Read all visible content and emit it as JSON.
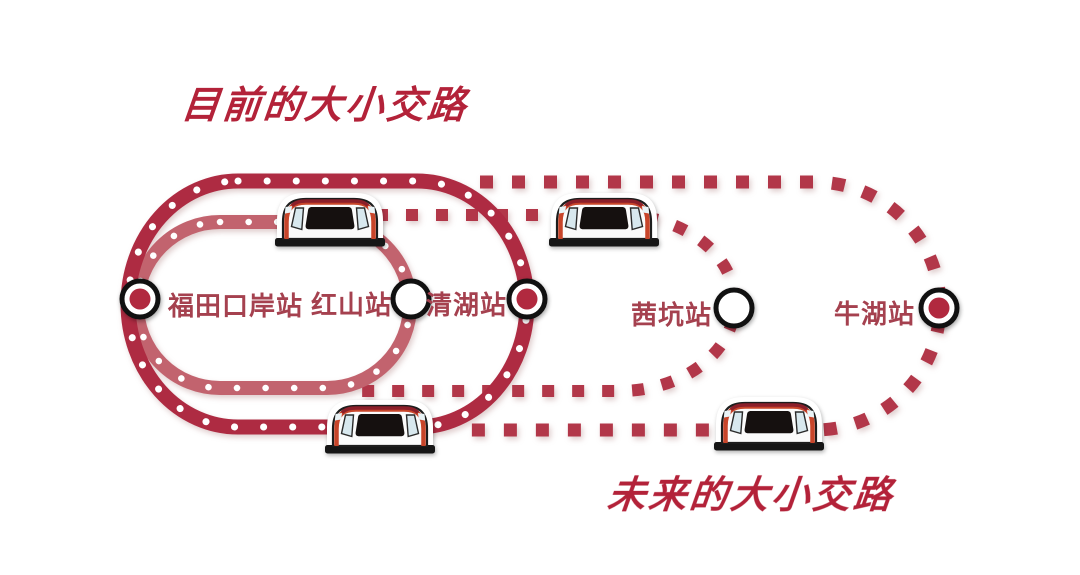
{
  "titles": {
    "current": "目前的大小交路",
    "future": "未来的大小交路"
  },
  "stations": [
    {
      "name": "福田口岸站",
      "marker": "filled"
    },
    {
      "name": "红山站",
      "marker": "hollow"
    },
    {
      "name": "清湖站",
      "marker": "filled"
    },
    {
      "name": "茜坑站",
      "marker": "hollow"
    },
    {
      "name": "牛湖站",
      "marker": "filled"
    }
  ],
  "routes": [
    {
      "name": "current-small-loop",
      "style": "solid-band-white-dots",
      "from": "福田口岸站",
      "to": "红山站"
    },
    {
      "name": "current-large-loop",
      "style": "solid-band-white-dots",
      "from": "福田口岸站",
      "to": "清湖站"
    },
    {
      "name": "future-small-loop",
      "style": "dotted-squares",
      "from": "红山站",
      "to": "茜坑站"
    },
    {
      "name": "future-large-loop",
      "style": "dotted-squares",
      "from": "清湖站",
      "to": "牛湖站"
    }
  ],
  "trains": [
    {
      "position": "top-of-current-small-loop"
    },
    {
      "position": "top-of-future-small-loop"
    },
    {
      "position": "bottom-of-current-large-loop"
    },
    {
      "position": "bottom-of-future-large-loop"
    }
  ],
  "colors": {
    "loop_current_large": "#ae2b42",
    "loop_current_small": "#c2636e",
    "loop_future": "#b23749",
    "station_fill": "#b1293f",
    "station_ring": "#111111",
    "station_label": "#a5414f",
    "title": "#b32239",
    "train_stripe": "#c8452a",
    "train_roof": "#8c1f2a"
  }
}
